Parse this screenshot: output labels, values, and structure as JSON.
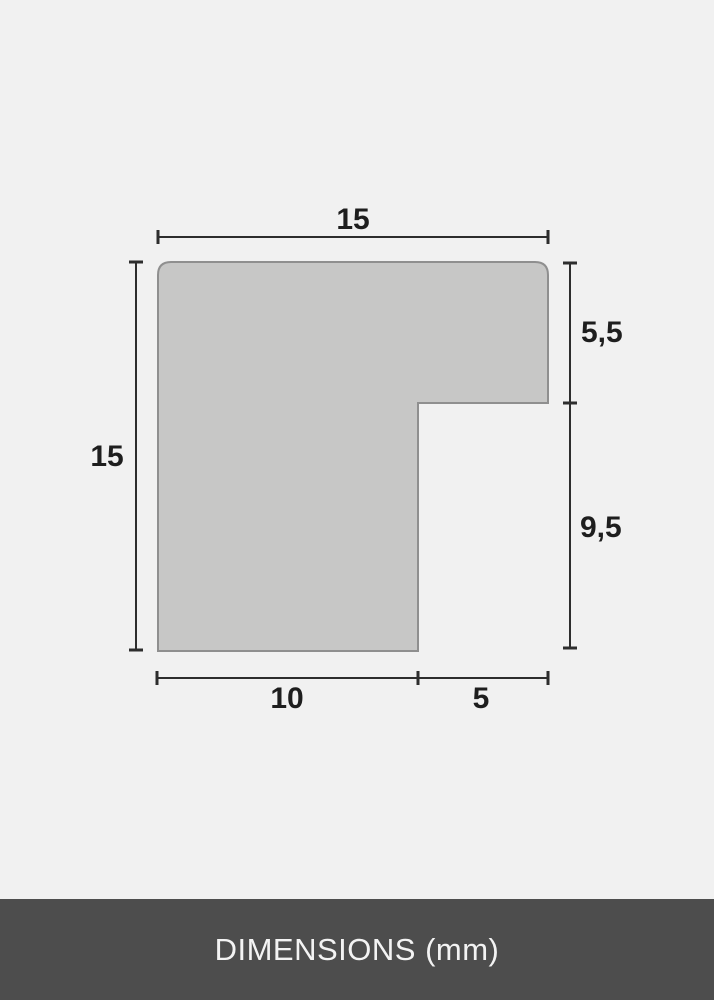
{
  "diagram": {
    "type": "profile-cross-section",
    "unit": "mm",
    "labels": {
      "top_width": "15",
      "left_height": "15",
      "right_upper_height": "5,5",
      "right_lower_height": "9,5",
      "bottom_inner_width": "10",
      "bottom_outer_width": "5"
    },
    "values_mm": {
      "top_width": 15,
      "left_height": 15,
      "right_upper_height": 5.5,
      "right_lower_height": 9.5,
      "bottom_inner_width": 10,
      "bottom_outer_width": 5
    },
    "colors": {
      "background": "#f1f1f1",
      "shape_fill": "#c7c7c6",
      "shape_stroke": "#8f8f8f",
      "dimension_line": "#2d2d2d",
      "label_text": "#1e1e1e",
      "footer_background": "#4d4d4d",
      "footer_text": "#f3f3f3"
    }
  },
  "footer": {
    "label": "DIMENSIONS (mm)"
  }
}
